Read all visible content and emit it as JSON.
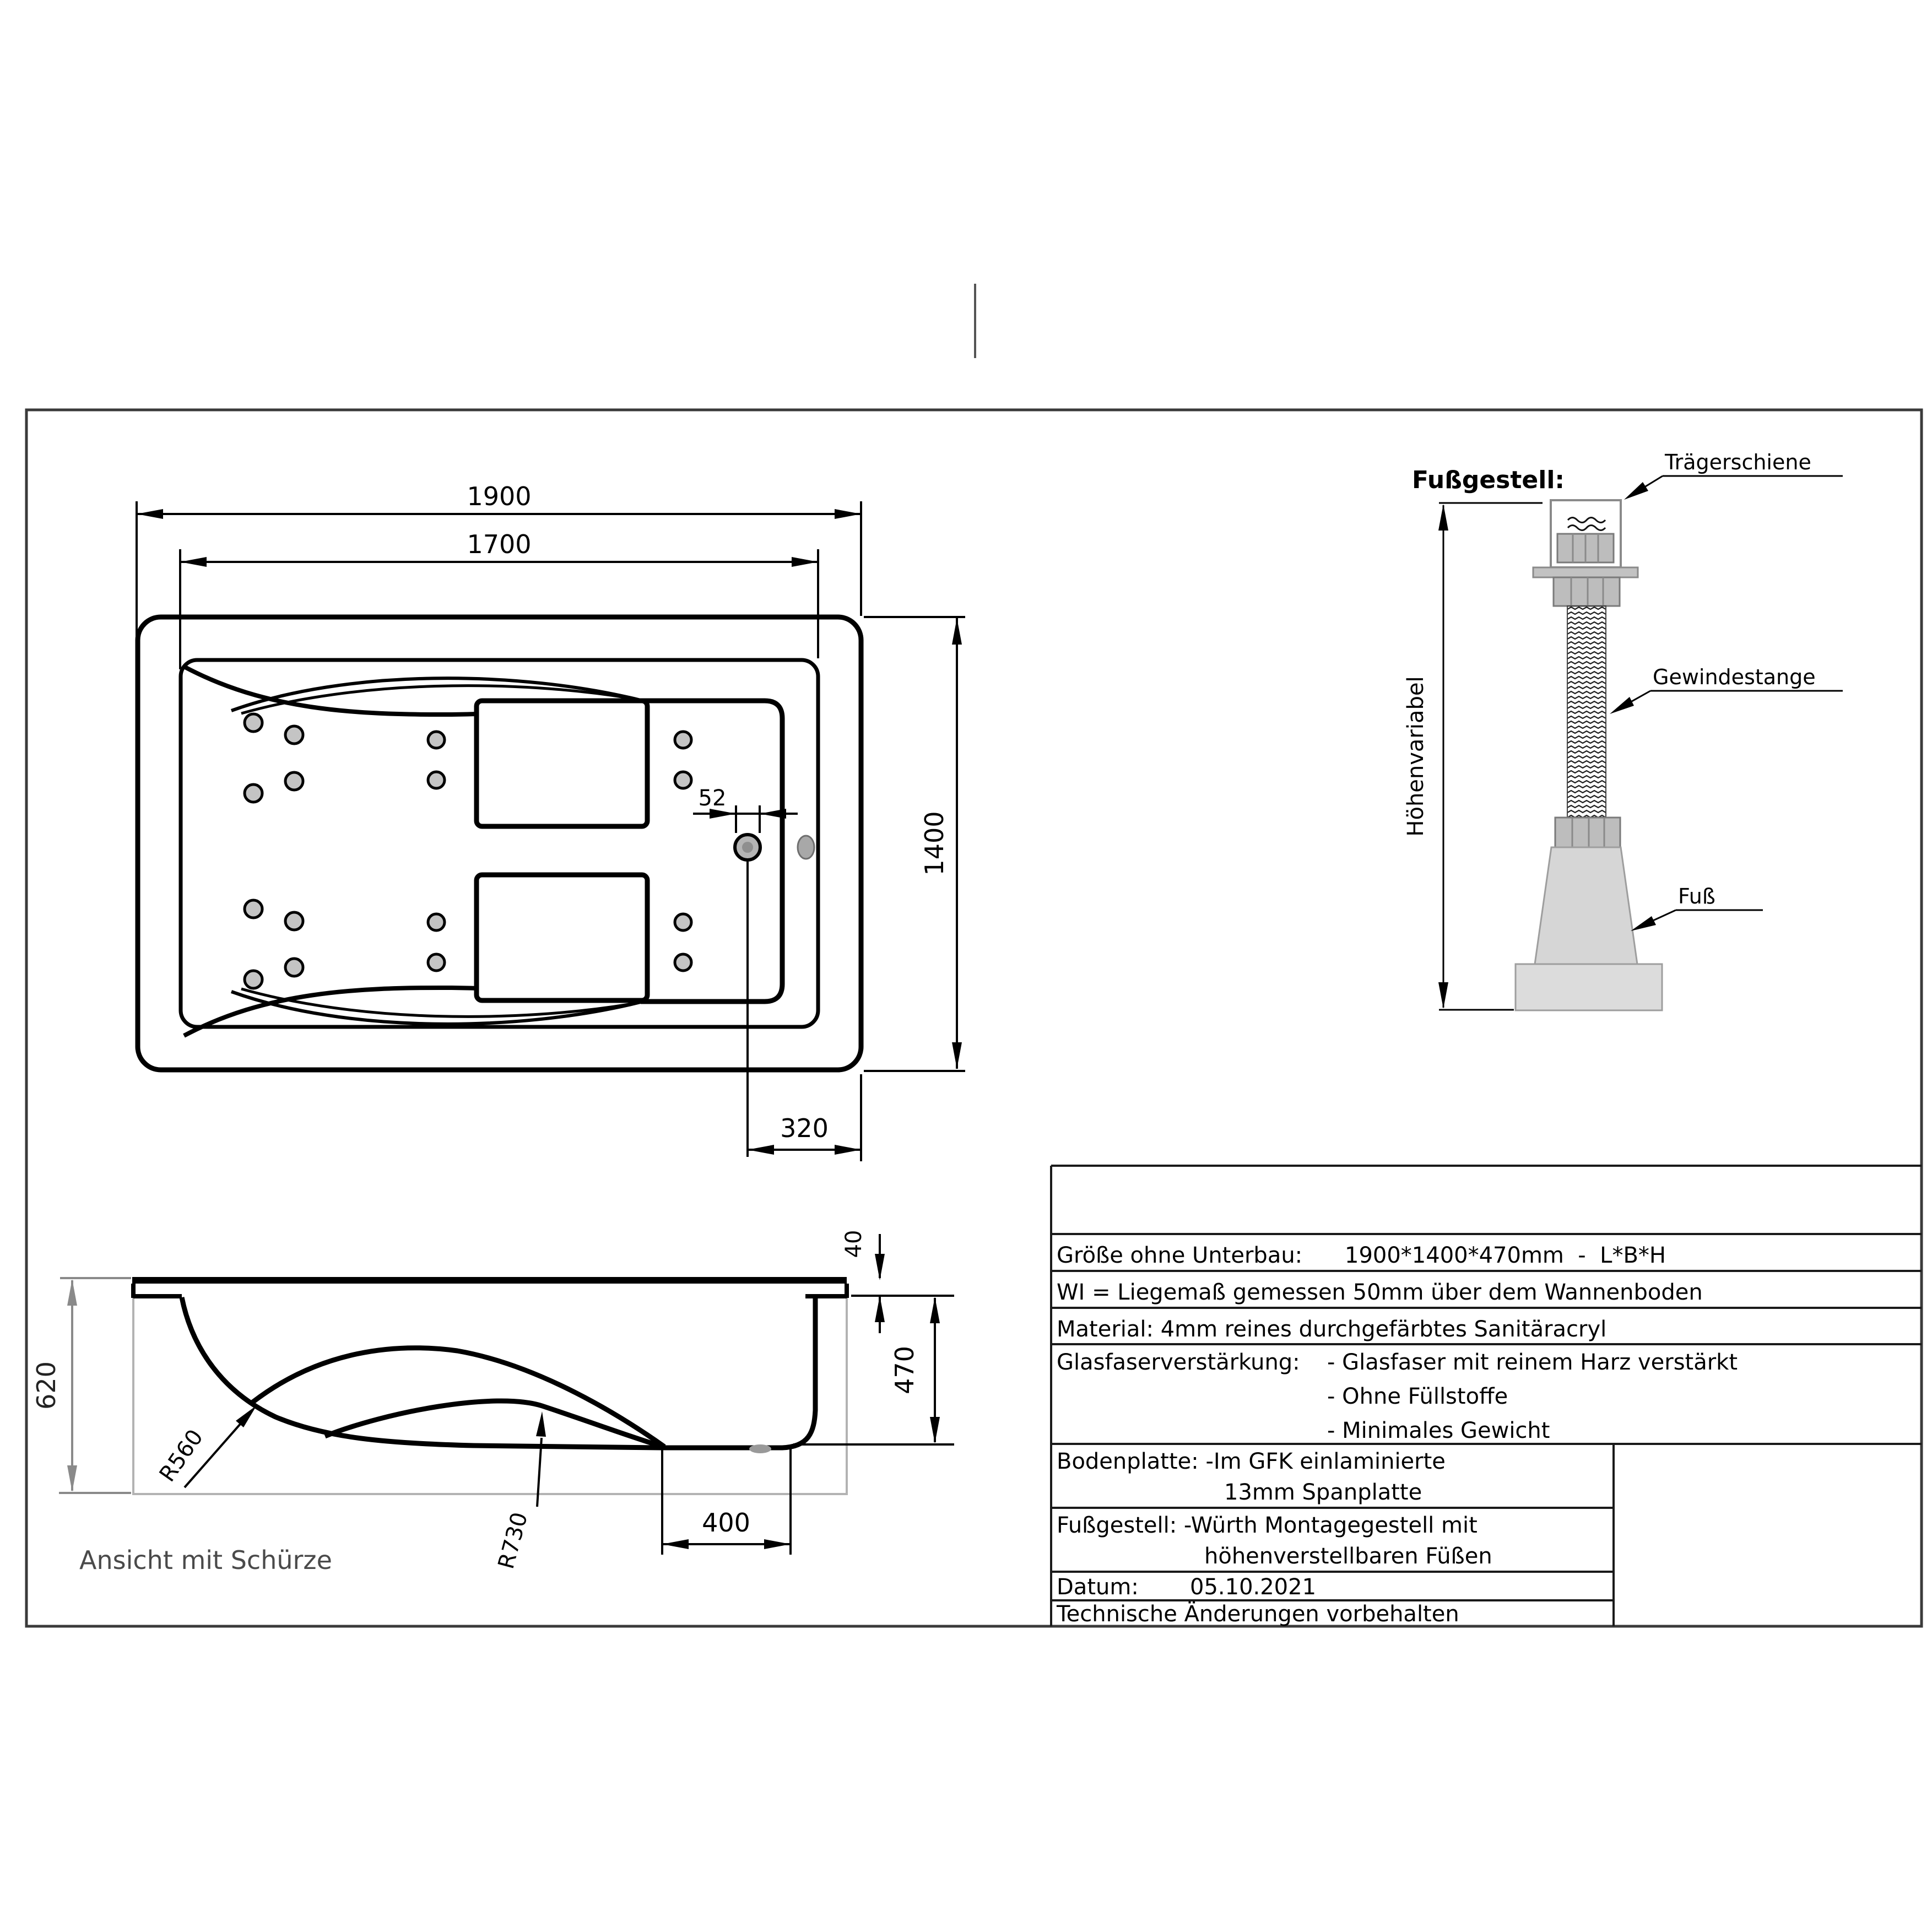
{
  "top_view": {
    "dim_outer_length": "1900",
    "dim_inner_length": "1700",
    "dim_width": "1400",
    "dim_drain": "52",
    "dim_drain_edge": "320"
  },
  "side_view": {
    "dim_height_total": "620",
    "dim_rim": "40",
    "dim_depth": "470",
    "dim_floor": "400",
    "radius_back": "R560",
    "radius_seat": "R730",
    "caption": "Ansicht mit Schürze"
  },
  "foot_detail": {
    "title": "Fußgestell:",
    "label_rail": "Trägerschiene",
    "label_rod": "Gewindestange",
    "label_foot": "Fuß",
    "label_height": "Höhenvariabel"
  },
  "spec_table": {
    "r2_label": "Größe ohne Unterbau:",
    "r2_value": "1900*1400*470mm  -  L*B*H",
    "r3": "WI = Liegemaß gemessen 50mm über dem Wannenboden",
    "r4": "Material: 4mm reines durchgefärbtes Sanitäracryl",
    "r5_label": "Glasfaserverstärkung:",
    "r5_item1": "- Glasfaser mit reinem Harz verstärkt",
    "r5_item2": "- Ohne Füllstoffe",
    "r5_item3": "- Minimales Gewicht",
    "r6_line1": "Bodenplatte: -Im GFK einlaminierte",
    "r6_line2": "13mm Spanplatte",
    "r7_line1": "Fußgestell: -Würth Montagegestell mit",
    "r7_line2": "höhenverstellbaren Füßen",
    "r8_label": "Datum:",
    "r8_value": "05.10.2021",
    "r9": "Technische Änderungen vorbehalten"
  },
  "colors": {
    "line": "#000000",
    "frame": "#3a3a3a",
    "jet_fill": "#c4c4c4",
    "metal": "#bdbdbd",
    "foot_gray": "#d6d6d6",
    "apron_gray": "#b3b3b3",
    "dim_gray": "#8a8a8a",
    "caption_gray": "#4a4a4a"
  }
}
